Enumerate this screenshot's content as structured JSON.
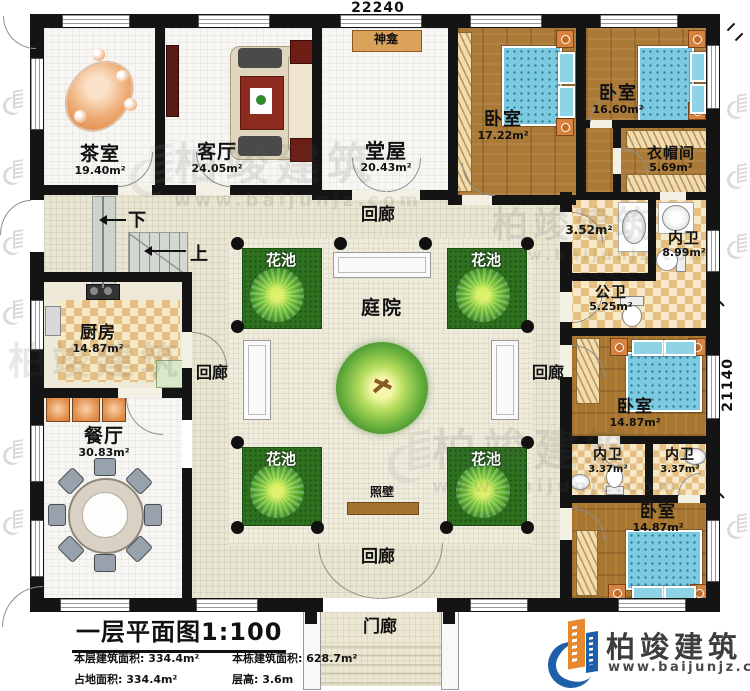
{
  "dimensions": {
    "top": "22240",
    "right": "21140"
  },
  "rooms": {
    "tea": {
      "name": "茶室",
      "area": "19.40m²"
    },
    "living": {
      "name": "客厅",
      "area": "24.05m²"
    },
    "hall": {
      "name": "堂屋",
      "area": "20.43m²"
    },
    "shrine": {
      "name": "神龛"
    },
    "bedroom_tl": {
      "name": "卧室",
      "area": "17.22m²"
    },
    "bedroom_tr": {
      "name": "卧室",
      "area": "16.60m²"
    },
    "cloakroom": {
      "name": "衣帽间",
      "area": "5.69m²"
    },
    "washroom": {
      "area": "3.52m²"
    },
    "ensuite_main": {
      "name": "内卫",
      "area": "8.99m²"
    },
    "public_wc": {
      "name": "公卫",
      "area": "5.25m²"
    },
    "bedroom_mr": {
      "name": "卧室",
      "area": "14.87m²"
    },
    "ensuite_left": {
      "name": "内卫",
      "area": "3.37m²"
    },
    "ensuite_right": {
      "name": "内卫",
      "area": "3.37m²"
    },
    "bedroom_br": {
      "name": "卧室",
      "area": "14.87m²"
    },
    "kitchen": {
      "name": "厨房",
      "area": "14.87m²"
    },
    "dining": {
      "name": "餐厅",
      "area": "30.83m²"
    },
    "courtyard": {
      "name": "庭院"
    },
    "flower_bed": {
      "name": "花池"
    },
    "corridor": {
      "name": "回廊"
    },
    "screen_wall": {
      "name": "照壁"
    },
    "porch": {
      "name": "门廊"
    },
    "stair_down": {
      "label": "下"
    },
    "stair_up": {
      "label": "上"
    }
  },
  "title_block": {
    "title": "一层平面图1:100",
    "stats": [
      "本层建筑面积: 334.4m²",
      "本栋建筑面积: 628.7m²",
      "占地面积: 334.4m²",
      "层高: 3.6m"
    ]
  },
  "brand": {
    "name": "柏竣建筑",
    "site": "www.baijunjz.com"
  }
}
